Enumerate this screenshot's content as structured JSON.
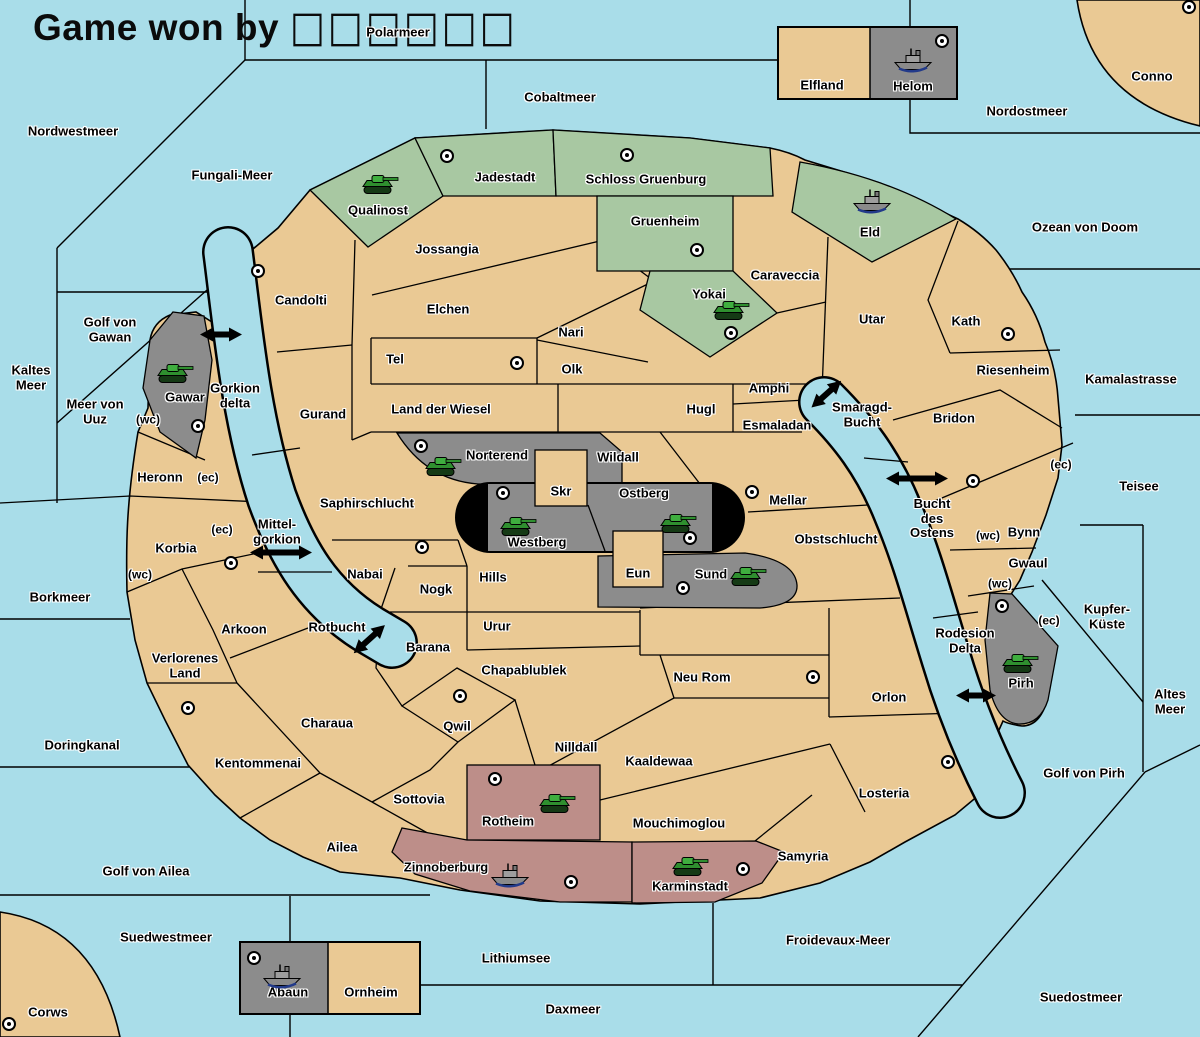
{
  "title": {
    "text": "Game won by ",
    "winner_placeholder": "□□□□□□"
  },
  "map": {
    "colors": {
      "water": "#a9dde9",
      "land": "#eac994",
      "border": "#000000",
      "green_power": "#a8c8a2",
      "gray_power": "#8c8c8c",
      "red_power": "#bd8e89",
      "army_color": "#2f8f2f",
      "fleet_color": "#8a8a8a",
      "pill": "#000000"
    },
    "seas": {
      "polarmeer": "Polarmeer",
      "nordwestmeer": "Nordwestmeer",
      "fungali_meer": "Fungali-Meer",
      "cobaltmeer": "Cobaltmeer",
      "nordostmeer": "Nordostmeer",
      "ozean_von_doom": "Ozean von Doom",
      "kaltes_meer": "Kaltes Meer",
      "golf_von_gawan": "Golf von Gawan",
      "meer_von_uuz": "Meer von Uuz",
      "gorkion_delta": "Gorkion delta",
      "kamalastrasse": "Kamalastrasse",
      "smaragd_bucht": "Smaragd-Bucht",
      "bucht_des_ostens": "Bucht des Ostens",
      "teisee": "Teisee",
      "mittel_gorkion": "Mittel-gorkion",
      "borkmeer": "Borkmeer",
      "kupfer_kueste": "Kupfer-Küste",
      "rotbucht": "Rotbucht",
      "rodesion_delta": "Rodesion Delta",
      "altes_meer": "Altes Meer",
      "doringkanal": "Doringkanal",
      "golf_von_pirh": "Golf von Pirh",
      "golf_von_ailea": "Golf von Ailea",
      "suedwestmeer": "Suedwestmeer",
      "lithiumsee": "Lithiumsee",
      "daxmeer": "Daxmeer",
      "froidevaux_meer": "Froidevaux-Meer",
      "suedostmeer": "Suedostmeer"
    },
    "territories": {
      "conno": "Conno",
      "elfland": "Elfland",
      "helom": "Helom",
      "eld": "Eld",
      "qualinost": "Qualinost",
      "jadestadt": "Jadestadt",
      "schloss_gruenburg": "Schloss Gruenburg",
      "gruenheim": "Gruenheim",
      "yokai": "Yokai",
      "caraveccia": "Caraveccia",
      "jossangia": "Jossangia",
      "candolti": "Candolti",
      "elchen": "Elchen",
      "nari": "Nari",
      "tel": "Tel",
      "olk": "Olk",
      "utar": "Utar",
      "kath": "Kath",
      "riesenheim": "Riesenheim",
      "bridon": "Bridon",
      "amphi": "Amphi",
      "hugl": "Hugl",
      "esmaladan": "Esmaladan",
      "land_der_wiesel": "Land der Wiesel",
      "gurand": "Gurand",
      "gawar": "Gawar",
      "heronn": "Heronn",
      "korbia": "Korbia",
      "norterend": "Norterend",
      "skr": "Skr",
      "wildall": "Wildall",
      "ostberg": "Ostberg",
      "westberg": "Westberg",
      "mellar": "Mellar",
      "obstschlucht": "Obstschlucht",
      "saphirschlucht": "Saphirschlucht",
      "nabai": "Nabai",
      "nogk": "Nogk",
      "hills": "Hills",
      "eun": "Eun",
      "sund": "Sund",
      "urur": "Urur",
      "barana": "Barana",
      "chapablublek": "Chapablublek",
      "neu_rom": "Neu Rom",
      "arkoon": "Arkoon",
      "verlorenes_land": "Verlorenes Land",
      "charaua": "Charaua",
      "qwil": "Qwil",
      "nilldall": "Nilldall",
      "kaaldewaa": "Kaaldewaa",
      "kentommenai": "Kentommenai",
      "sottovia": "Sottovia",
      "ailea": "Ailea",
      "rotheim": "Rotheim",
      "mouchimoglou": "Mouchimoglou",
      "zinnoberburg": "Zinnoberburg",
      "karminstadt": "Karminstadt",
      "samyria": "Samyria",
      "orlon": "Orlon",
      "losteria": "Losteria",
      "bynn": "Bynn",
      "gwaul": "Gwaul",
      "pirh": "Pirh",
      "abaun": "Abaun",
      "ornheim": "Ornheim",
      "corws": "Corws"
    },
    "coast_markers": {
      "west": "(wc)",
      "east": "(ec)"
    },
    "supply_centers": [
      "Conno",
      "Helom",
      "Jadestadt",
      "Schloss Gruenburg",
      "Candolti",
      "Gruenheim",
      "Yokai",
      "Kath",
      "Tel",
      "Gawar",
      "Norterend",
      "Bridon",
      "Westberg",
      "Mellar",
      "Ostberg",
      "Nabai",
      "Korbia",
      "Sund",
      "Pirh",
      "Qwil",
      "Verlorenes Land",
      "Neu Rom",
      "Losteria",
      "Rotheim",
      "Karminstadt",
      "Zinnoberburg",
      "Abaun",
      "Corws"
    ],
    "units": [
      {
        "type": "fleet",
        "territory": "Helom"
      },
      {
        "type": "fleet",
        "territory": "Eld"
      },
      {
        "type": "army",
        "territory": "Qualinost"
      },
      {
        "type": "army",
        "territory": "Yokai"
      },
      {
        "type": "army",
        "territory": "Gawar"
      },
      {
        "type": "army",
        "territory": "Norterend"
      },
      {
        "type": "army",
        "territory": "Westberg"
      },
      {
        "type": "army",
        "territory": "Ostberg"
      },
      {
        "type": "army",
        "territory": "Sund"
      },
      {
        "type": "army",
        "territory": "Pirh"
      },
      {
        "type": "army",
        "territory": "Rotheim"
      },
      {
        "type": "fleet",
        "territory": "Zinnoberburg"
      },
      {
        "type": "army",
        "territory": "Karminstadt"
      },
      {
        "type": "fleet",
        "territory": "Abaun"
      }
    ]
  }
}
